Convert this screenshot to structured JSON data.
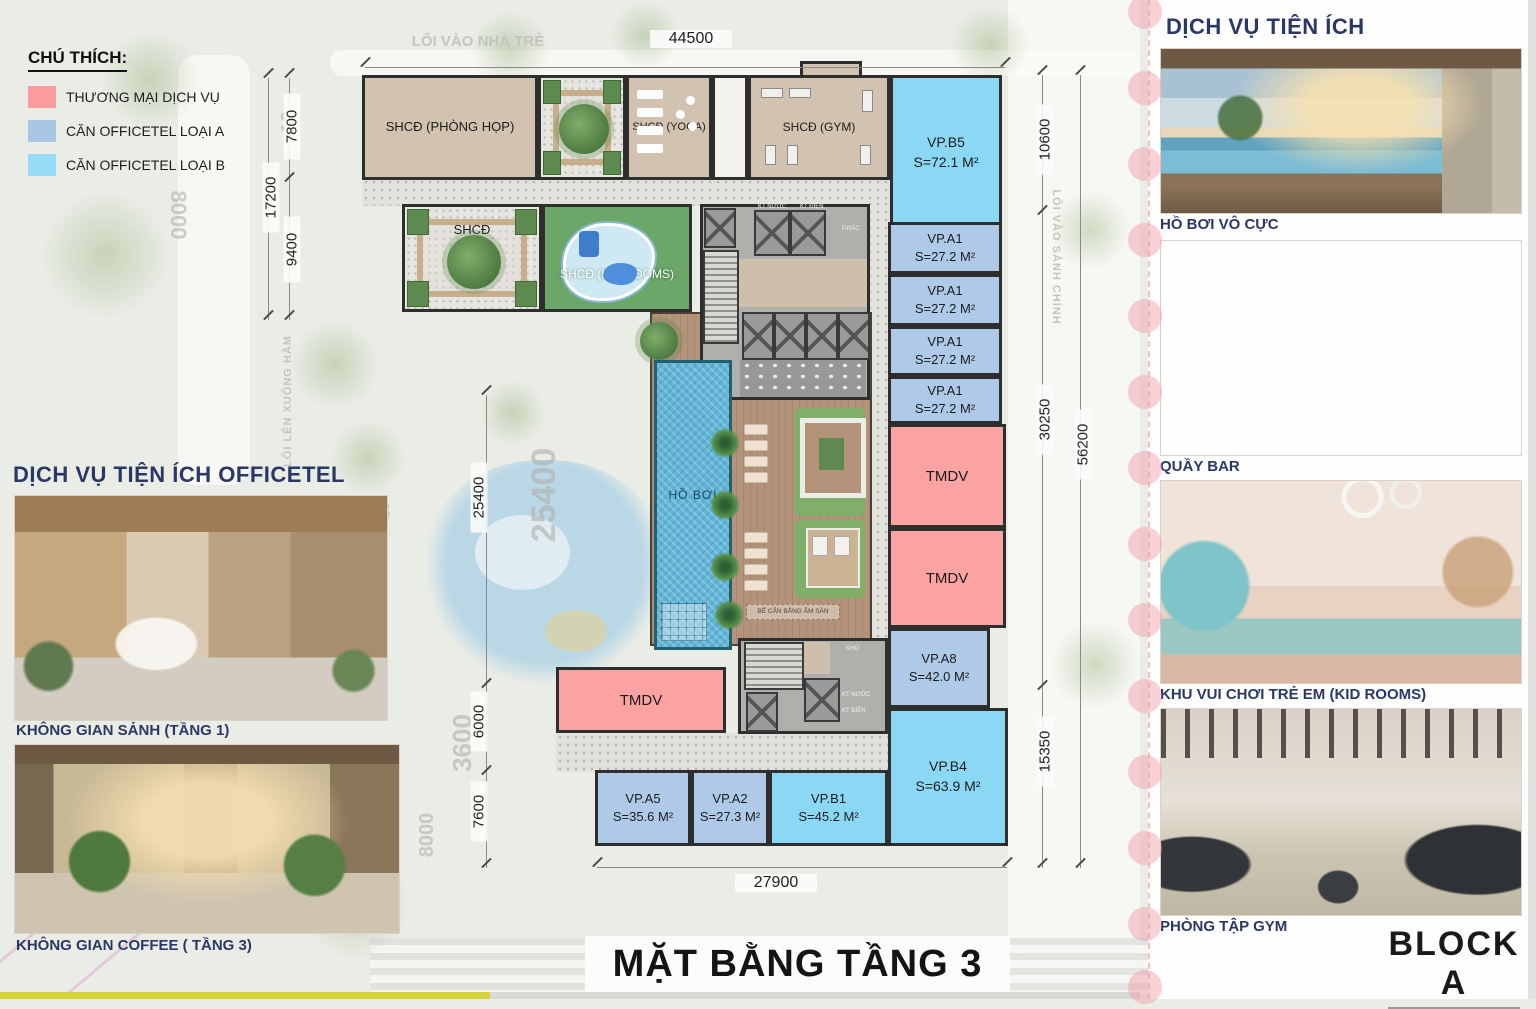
{
  "title": {
    "plan_title": "MẶT BẰNG TẦNG 3",
    "block_label": "BLOCK A"
  },
  "legend": {
    "title": "CHÚ THÍCH:",
    "items": [
      {
        "label": "THƯƠNG MẠI DỊCH VỤ",
        "color": "#FB9C9C"
      },
      {
        "label": "CĂN OFFICETEL LOẠI A",
        "color": "#A9C6E4"
      },
      {
        "label": "CĂN OFFICETEL LOẠI B",
        "color": "#96DBF7"
      }
    ]
  },
  "colors": {
    "tmdv": "#FBA2A2",
    "officetel_a": "#AECAE8",
    "officetel_b": "#8BD8F5",
    "shcd_beige": "#D2C3B1",
    "kids_green": "#6CA76A",
    "heading_navy": "#2B3866"
  },
  "left_panel": {
    "heading": "DỊCH VỤ TIỆN ÍCH OFFICETEL",
    "photos": [
      {
        "caption": "KHÔNG GIAN SẢNH (TẦNG 1)"
      },
      {
        "caption": "KHÔNG GIAN COFFEE ( TẦNG 3)"
      }
    ]
  },
  "right_panel": {
    "heading": "DỊCH VỤ TIỆN ÍCH",
    "photos": [
      {
        "caption": "HỒ BƠI VÔ CỰC"
      },
      {
        "caption": "QUẦY BAR"
      },
      {
        "caption": "KHU VUI CHƠI TRẺ EM (KID ROOMS)"
      },
      {
        "caption": "PHÒNG TẬP GYM"
      }
    ],
    "block_label": "BLOCK A"
  },
  "site_labels": {
    "top": "LỐI VÀO NHÀ TRẺ",
    "left_vertical": "LỐI LÊN XUỐNG HẦM",
    "right_vertical": "LỐI VÀO SẢNH CHÍNH"
  },
  "plan": {
    "rooms": {
      "meeting": {
        "label": "SHCĐ (PHÒNG HỌP)"
      },
      "court_top": {
        "label": "SHCĐ"
      },
      "yoga": {
        "label": "SHCĐ (YOGA)"
      },
      "gym": {
        "label": "SHCĐ (GYM)"
      },
      "vp_b5": {
        "label": "VP.B5",
        "area": "S=72.1 M²"
      },
      "court_mid": {
        "label": "SHCĐ"
      },
      "kids": {
        "label": "SHCĐ (KID ROOMS)"
      },
      "vp_a1": {
        "label": "VP.A1",
        "area": "S=27.2 M²"
      },
      "tmdv": {
        "label": "TMDV"
      },
      "vp_a8": {
        "label": "VP.A8",
        "area": "S=42.0 M²"
      },
      "vp_b4": {
        "label": "VP.B4",
        "area": "S=63.9 M²"
      },
      "vp_a5": {
        "label": "VP.A5",
        "area": "S=35.6 M²"
      },
      "vp_a2": {
        "label": "VP.A2",
        "area": "S=27.3 M²"
      },
      "vp_b1": {
        "label": "VP.B1",
        "area": "S=45.2 M²"
      },
      "pool": {
        "label": "HỒ BƠI"
      },
      "balance": {
        "label": "BỂ CÂN BẰNG ÂM SÀN"
      }
    },
    "core": {
      "kt_nuoc": "KT NƯỚC",
      "kt_dien": "KT ĐIỆN",
      "p_rac": "P.RÁC",
      "kho": "KHO"
    }
  },
  "dimensions": {
    "top_44500": "44500",
    "bottom_27900": "27900",
    "right_10600": "10600",
    "right_30250": "30250",
    "right_56200": "56200",
    "right_15350": "15350",
    "left_7800": "7800",
    "left_17200": "17200",
    "left_9400": "9400",
    "left_25400": "25400",
    "left_6000": "6000",
    "left_7600": "7600"
  },
  "ghost_texts": {
    "g25400": "25400",
    "g3600": "3600",
    "g8000a": "8000",
    "g8000b": "8000",
    "g19": "19",
    "g48": "48"
  }
}
